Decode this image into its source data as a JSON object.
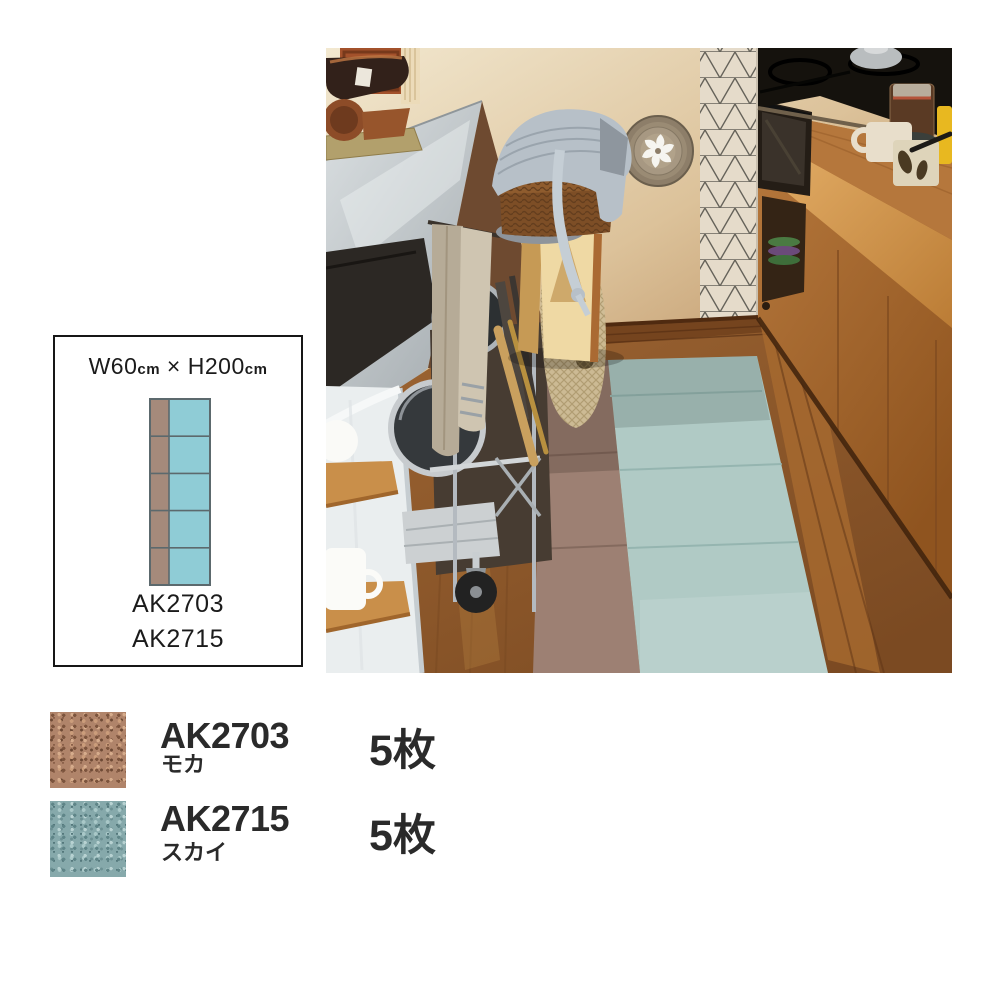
{
  "photo": {
    "description": "kitchen scene with two-color tile-carpet runner on wood floor",
    "palette": {
      "wall_light": "#f2e8d0",
      "wall_tan": "#bb8f60",
      "counter_steel": "#c3c9cd",
      "sink": "#2c2824",
      "island_white": "#eaeeef",
      "wood_floor_left": "#a86f3a",
      "wood_floor_right": "#8a5226",
      "cabinet_wood": "#ad6d33",
      "stove_black": "#15120d",
      "tile_wall": "#e5dbca",
      "rug_mocha": "#9d8073",
      "rug_sky": "#b0cac5",
      "basket": "#8f5c2e",
      "cloth_grey": "#b7c0c8"
    }
  },
  "diagram": {
    "title": {
      "w": "W60",
      "w_unit": "cm",
      "times": " × ",
      "h": "H200",
      "h_unit": "cm"
    },
    "codes": {
      "first": "AK2703",
      "second": "AK2715"
    },
    "tiles": {
      "rows": 5,
      "mocha_color": "#a58a7b",
      "sky_color": "#8fccd6",
      "line_color": "#5c696d"
    }
  },
  "legend": {
    "items": [
      {
        "code": "AK2703",
        "name": "モカ",
        "count": "5枚",
        "swatch": "#b0846a"
      },
      {
        "code": "AK2715",
        "name": "スカイ",
        "count": "5枚",
        "swatch": "#86a9ab"
      }
    ]
  }
}
